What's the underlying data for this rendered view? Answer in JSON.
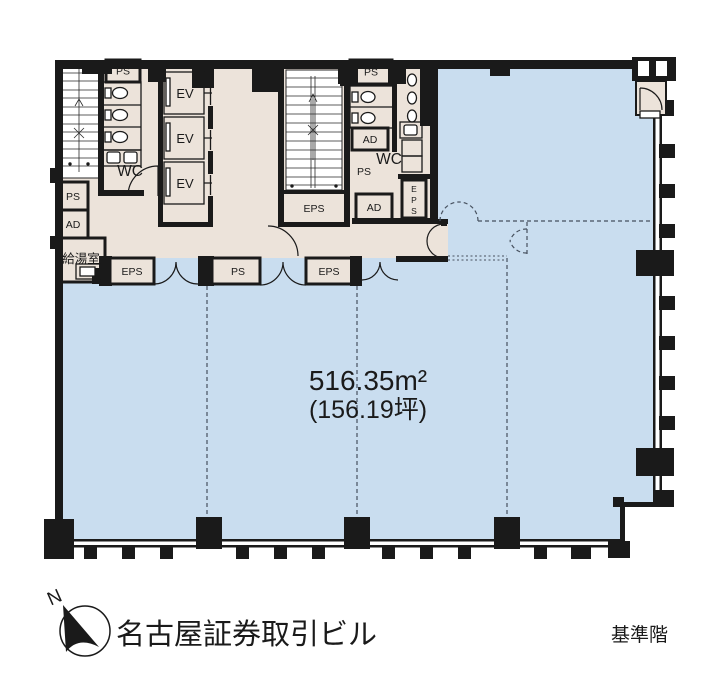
{
  "colors": {
    "wall": "#1a1a1a",
    "core": "#ece3da",
    "tenant": "#c9ddef",
    "dash": "#46505e",
    "text": "#1a1a1a",
    "white": "#ffffff"
  },
  "labels": {
    "ps": "PS",
    "ad": "AD",
    "ev": "EV",
    "wc": "WC",
    "eps": "EPS",
    "kitchenette": "給湯室",
    "eps_v": {
      "l1": "E",
      "l2": "P",
      "l3": "S"
    }
  },
  "area": {
    "m2": "516.35m²",
    "tsubo": "(156.19坪)"
  },
  "footer": {
    "north": "N",
    "building_name": "名古屋証券取引ビル",
    "floor_label": "基準階"
  }
}
